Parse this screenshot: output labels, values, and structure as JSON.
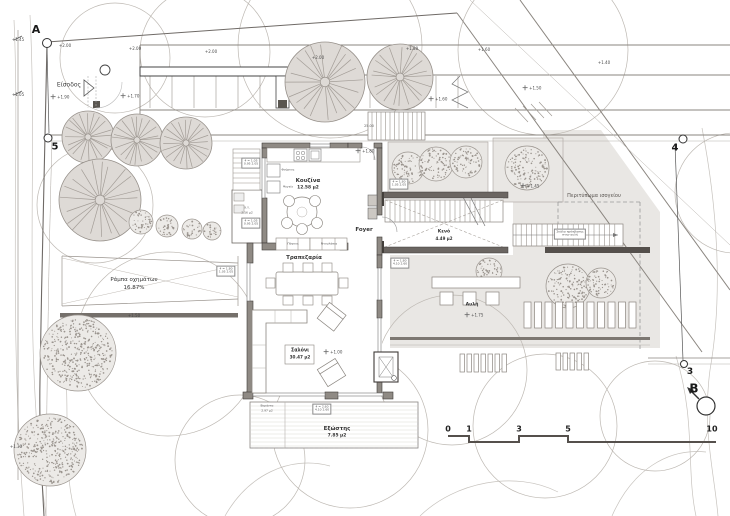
{
  "markers": {
    "a": "A",
    "n5": "5",
    "n4": "4",
    "n3": "3",
    "b": "B"
  },
  "rooms": {
    "kitchen": {
      "name": "Κουζίνα",
      "area": "12.58 μ2"
    },
    "foyer": {
      "name": "Foyer"
    },
    "dining": {
      "name": "Τραπεζαρία"
    },
    "living": {
      "name": "Σαλόνι",
      "area": "30.47 μ2"
    },
    "balcony": {
      "name": "Εξώστης",
      "area": "7.85 μ2"
    },
    "void": {
      "name": "Κενό",
      "area": "4.49 μ2"
    },
    "courtyard": {
      "name": "Αυλή"
    },
    "wc": {
      "name": "Χ.Υ.",
      "area": "2.16 μ2"
    },
    "veranda": {
      "name": "Βεράντα",
      "area": "2.97 μ2"
    }
  },
  "site": {
    "entrance": "Είσοδος",
    "ramp": "Ράμπα οχημάτων",
    "ramp_slope": "16.87%",
    "footprint": "Περιτύπωμα ισογείου",
    "stair_note_1": "Σκάλα πρόσβασης",
    "stair_note_2": "στην αυλή",
    "dim_25": "25.00"
  },
  "kitchen_notes": {
    "oven": "Φούρνος",
    "fridge": "Ψυγείο",
    "counter": "Πάγκος",
    "cabinets": "Ντουλάπια"
  },
  "elevations": [
    {
      "v": "+1.45"
    },
    {
      "v": "+1.05"
    },
    {
      "v": "+1.30"
    },
    {
      "v": "+2.00"
    },
    {
      "v": "+2.00"
    },
    {
      "v": "+2.00"
    },
    {
      "v": "+2.00"
    },
    {
      "v": "+1.80"
    },
    {
      "v": "+1.60"
    },
    {
      "v": "+1.40"
    },
    {
      "v": "+1.90"
    },
    {
      "v": "+1.70"
    },
    {
      "v": "+1.60"
    },
    {
      "v": "+1.50"
    },
    {
      "v": "+1.45"
    },
    {
      "v": "+1.80"
    },
    {
      "v": "+1.00"
    },
    {
      "v": "+1.75"
    },
    {
      "v": "+1.50"
    }
  ],
  "tags": [
    {
      "l1": "4 = 1.05",
      "l2": "0.95 2.05"
    },
    {
      "l1": "4 = 1.05",
      "l2": "0.95 2.05"
    },
    {
      "l1": "4 = 1.80",
      "l2": "1.05 2.05"
    },
    {
      "l1": "4 = 1.80",
      "l2": "4.10 2.60"
    },
    {
      "l1": "4 = 2.60",
      "l2": "4.10 2.60"
    },
    {
      "l1": "4 = 1.80",
      "l2": "1.05 2.05"
    }
  ],
  "scale_bar": {
    "labels": [
      "0",
      "1",
      "3",
      "5",
      "10"
    ]
  }
}
